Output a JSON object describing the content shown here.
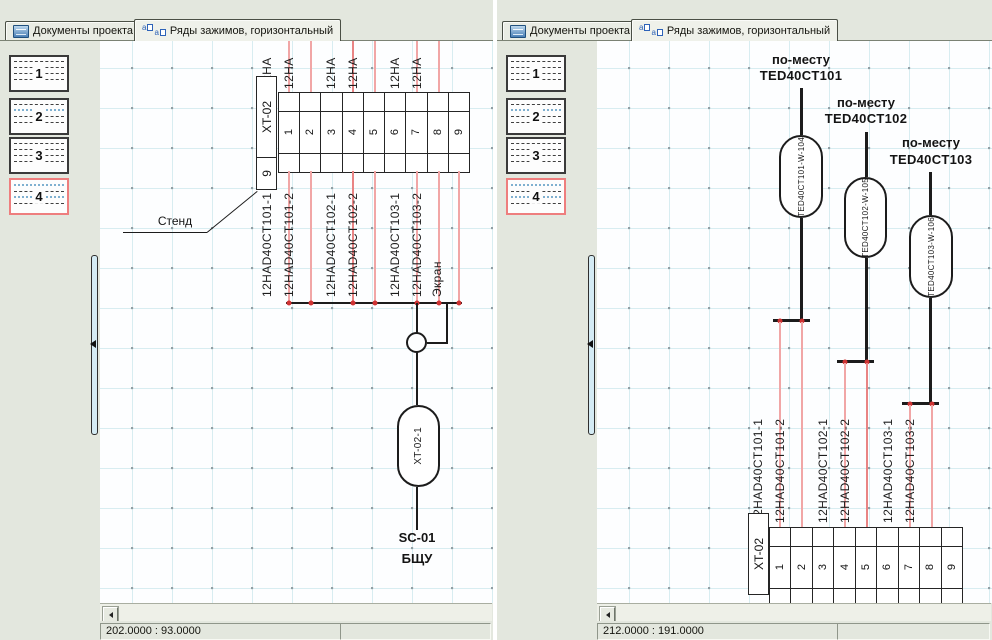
{
  "tabs": {
    "documents": "Документы проекта",
    "terminal_rows": "Ряды зажимов, горизонтальный"
  },
  "icons": {
    "tab_documents": "documents-icon",
    "tab_terminal_rows": "terminal-rows-icon",
    "sidebar_collapse": "collapse-left-arrow-icon",
    "scroll_left": "scroll-left-arrow-icon"
  },
  "colors": {
    "background": "#e3e7de",
    "grid": "#d8edf1",
    "wire_pink": "#f1a6a6",
    "junction_red": "#cf3333",
    "selected_page_border": "#ee7e7e",
    "diagram_line": "#1c1c1c"
  },
  "pages": [
    "1",
    "2",
    "3",
    "4"
  ],
  "terminals": [
    "1",
    "2",
    "3",
    "4",
    "5",
    "6",
    "7",
    "8",
    "9"
  ],
  "left_view": {
    "block_tag": "XT-02",
    "block_size": "9",
    "incoming_wire_label": "12HA",
    "wires": [
      "12HAD40CT101-1",
      "12HAD40CT101-2",
      "12HAD40CT102-1",
      "12HAD40CT102-2",
      "12HAD40CT103-1",
      "12HAD40CT103-2",
      "Экран"
    ],
    "note": "Стенд",
    "link_tag": "XT-02-1",
    "destination_line1": "SC-01",
    "destination_line2": "БЩУ",
    "coords": "202.0000 : 93.0000"
  },
  "right_view": {
    "sensors": [
      {
        "location": "по-месту",
        "tag": "TED40CT101",
        "cable": "TED40CT101-W-104",
        "wires": [
          "12HAD40CT101-1",
          "12HAD40CT101-2"
        ]
      },
      {
        "location": "по-месту",
        "tag": "TED40CT102",
        "cable": "TED40CT102-W-105",
        "wires": [
          "12HAD40CT102-1",
          "12HAD40CT102-2"
        ]
      },
      {
        "location": "по-месту",
        "tag": "TED40CT103",
        "cable": "TED40CT103-W-106",
        "wires": [
          "12HAD40CT103-1",
          "12HAD40CT103-2"
        ]
      }
    ],
    "block_tag": "XT-02",
    "coords": "212.0000 : 191.0000"
  }
}
